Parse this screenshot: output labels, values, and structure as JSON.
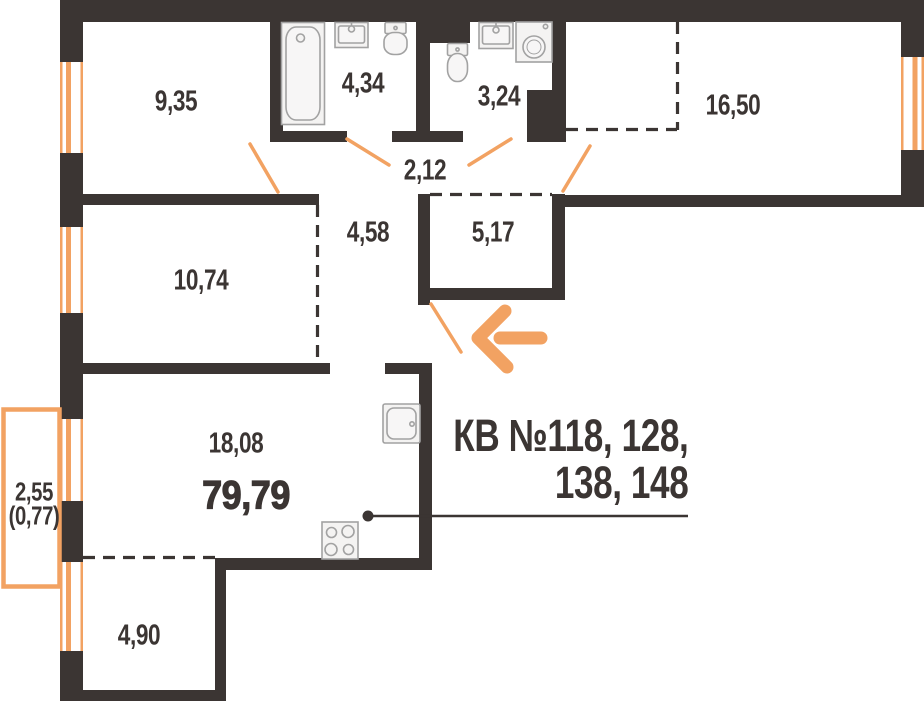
{
  "plan": {
    "rooms": [
      {
        "area": "9,35"
      },
      {
        "area": "4,34"
      },
      {
        "area": "3,24"
      },
      {
        "area": "16,50"
      },
      {
        "area": "2,12"
      },
      {
        "area": "4,58"
      },
      {
        "area": "5,17"
      },
      {
        "area": "10,74"
      },
      {
        "area": "18,08"
      },
      {
        "area": "4,90"
      }
    ],
    "total_area": "79,79",
    "balcony": {
      "area": "2,55",
      "area_reduced": "(0,77)"
    },
    "callout": {
      "line1": "КВ №118, 128,",
      "line2": "138, 148"
    },
    "colors": {
      "wall": "#3B3533",
      "accent": "#F2A262"
    }
  }
}
